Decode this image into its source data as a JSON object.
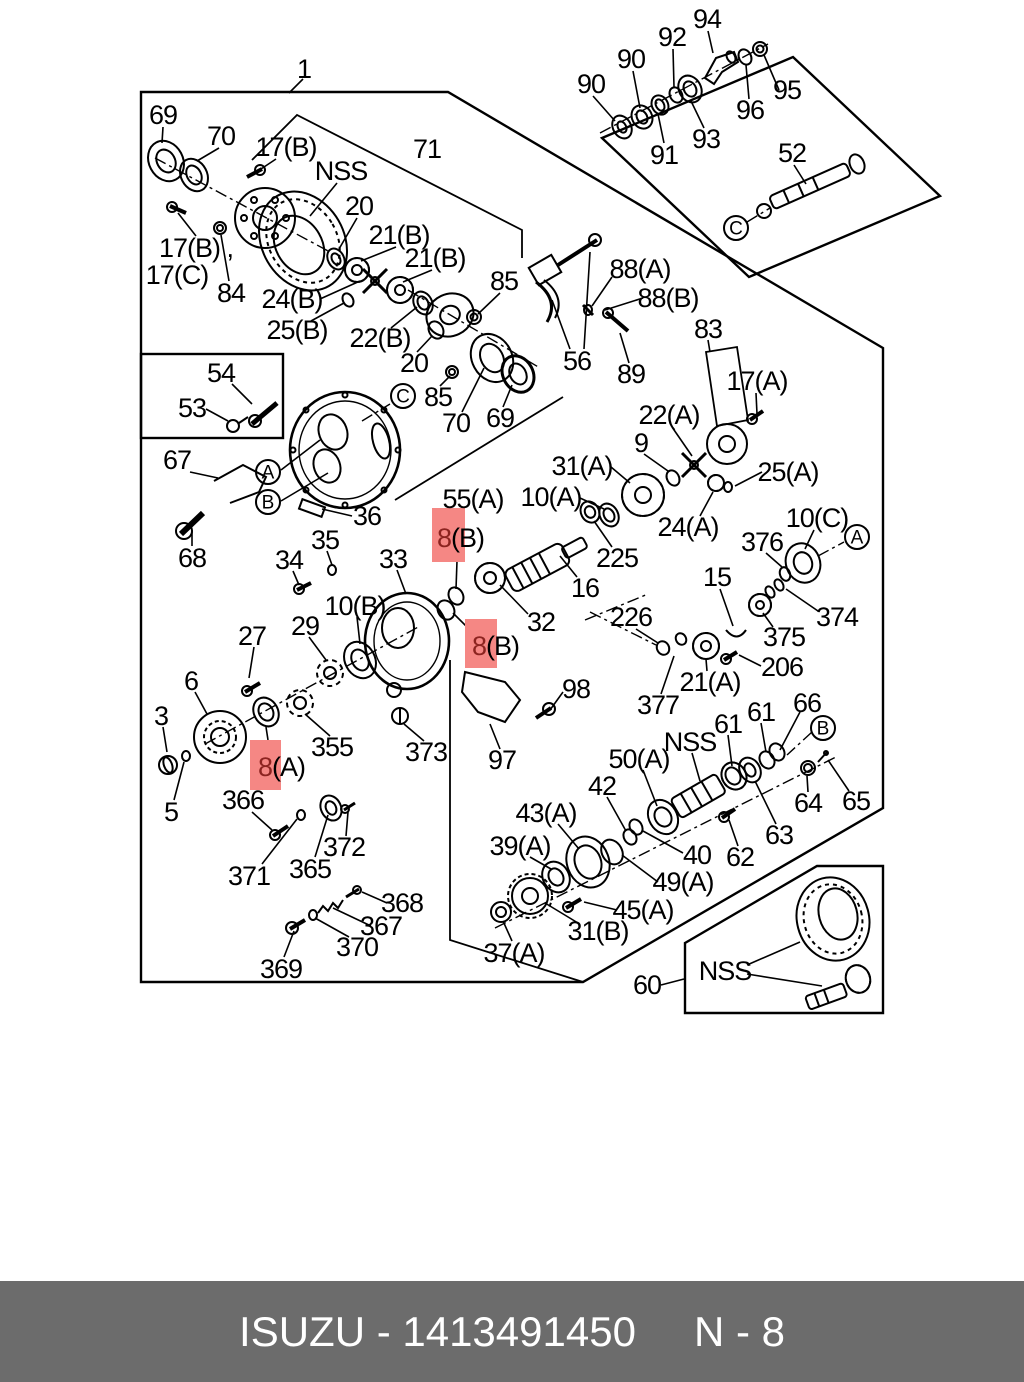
{
  "page": {
    "bg": "#ffffff",
    "line_color": "#000000"
  },
  "footer": {
    "left_text": "ISUZU - 1413491450",
    "right_text": "N - 8",
    "bg": "#6c6c6c",
    "color": "#ffffff"
  },
  "highlight": {
    "fill": "#f58784",
    "digit_color": "#8c2420"
  },
  "diagram": {
    "labels": [
      {
        "t": "1",
        "x": 304,
        "y": 69
      },
      {
        "t": "69",
        "x": 163,
        "y": 115
      },
      {
        "t": "70",
        "x": 221,
        "y": 136
      },
      {
        "t": "17(B)",
        "x": 286,
        "y": 147
      },
      {
        "t": "NSS",
        "x": 341,
        "y": 171
      },
      {
        "t": "71",
        "x": 427,
        "y": 149
      },
      {
        "t": "20",
        "x": 359,
        "y": 206
      },
      {
        "t": "21(B)",
        "x": 399,
        "y": 235
      },
      {
        "t": "21(B)",
        "x": 435,
        "y": 258
      },
      {
        "t": "85",
        "x": 504,
        "y": 281
      },
      {
        "t": "17(B) ,",
        "x": 196,
        "y": 248
      },
      {
        "t": "17(C)",
        "x": 177,
        "y": 275
      },
      {
        "t": "84",
        "x": 231,
        "y": 293
      },
      {
        "t": "24(B)",
        "x": 292,
        "y": 299
      },
      {
        "t": "25(B)",
        "x": 297,
        "y": 330
      },
      {
        "t": "22(B)",
        "x": 380,
        "y": 338
      },
      {
        "t": "20",
        "x": 414,
        "y": 363
      },
      {
        "t": "54",
        "x": 221,
        "y": 373
      },
      {
        "t": "53",
        "x": 192,
        "y": 408
      },
      {
        "t": "85",
        "x": 438,
        "y": 397
      },
      {
        "t": "70",
        "x": 456,
        "y": 423
      },
      {
        "t": "69",
        "x": 500,
        "y": 418
      },
      {
        "t": "56",
        "x": 577,
        "y": 361
      },
      {
        "t": "88(A)",
        "x": 640,
        "y": 269
      },
      {
        "t": "88(B)",
        "x": 668,
        "y": 298
      },
      {
        "t": "89",
        "x": 631,
        "y": 374
      },
      {
        "t": "83",
        "x": 708,
        "y": 329
      },
      {
        "t": "17(A)",
        "x": 757,
        "y": 381
      },
      {
        "t": "67",
        "x": 177,
        "y": 460
      },
      {
        "t": "68",
        "x": 192,
        "y": 558
      },
      {
        "t": "22(A)",
        "x": 669,
        "y": 415
      },
      {
        "t": "9",
        "x": 641,
        "y": 443
      },
      {
        "t": "31(A)",
        "x": 582,
        "y": 466
      },
      {
        "t": "10(A)",
        "x": 551,
        "y": 497
      },
      {
        "t": "25(A)",
        "x": 788,
        "y": 472
      },
      {
        "t": "24(A)",
        "x": 688,
        "y": 527
      },
      {
        "t": "10(C)",
        "x": 817,
        "y": 518
      },
      {
        "t": "376",
        "x": 762,
        "y": 542
      },
      {
        "t": "225",
        "x": 617,
        "y": 558
      },
      {
        "t": "15",
        "x": 717,
        "y": 577
      },
      {
        "t": "374",
        "x": 837,
        "y": 617
      },
      {
        "t": "375",
        "x": 784,
        "y": 637
      },
      {
        "t": "226",
        "x": 631,
        "y": 617
      },
      {
        "t": "206",
        "x": 782,
        "y": 667
      },
      {
        "t": "16",
        "x": 585,
        "y": 588
      },
      {
        "t": "32",
        "x": 541,
        "y": 622
      },
      {
        "t": "55(A)",
        "x": 473,
        "y": 499
      },
      {
        "t": "8(B)",
        "x": 437,
        "y": 538,
        "anchor": "start",
        "hl": true,
        "box": {
          "x": 432,
          "y": 508,
          "w": 33,
          "h": 54
        }
      },
      {
        "t": "8(B)",
        "x": 472,
        "y": 646,
        "anchor": "start",
        "hl": true,
        "box": {
          "x": 465,
          "y": 619,
          "w": 32,
          "h": 49
        }
      },
      {
        "t": "8(A)",
        "x": 258,
        "y": 767,
        "anchor": "start",
        "hl": true,
        "box": {
          "x": 250,
          "y": 740,
          "w": 31,
          "h": 50
        }
      },
      {
        "t": "36",
        "x": 367,
        "y": 516
      },
      {
        "t": "35",
        "x": 325,
        "y": 540
      },
      {
        "t": "34",
        "x": 289,
        "y": 560
      },
      {
        "t": "33",
        "x": 393,
        "y": 559
      },
      {
        "t": "10(B)",
        "x": 355,
        "y": 606
      },
      {
        "t": "29",
        "x": 305,
        "y": 626
      },
      {
        "t": "27",
        "x": 252,
        "y": 636
      },
      {
        "t": "98",
        "x": 576,
        "y": 689
      },
      {
        "t": "6",
        "x": 191,
        "y": 681
      },
      {
        "t": "3",
        "x": 161,
        "y": 716
      },
      {
        "t": "5",
        "x": 171,
        "y": 812
      },
      {
        "t": "355",
        "x": 332,
        "y": 747
      },
      {
        "t": "373",
        "x": 426,
        "y": 752
      },
      {
        "t": "97",
        "x": 502,
        "y": 760
      },
      {
        "t": "366",
        "x": 243,
        "y": 800
      },
      {
        "t": "371",
        "x": 249,
        "y": 876
      },
      {
        "t": "365",
        "x": 310,
        "y": 869
      },
      {
        "t": "372",
        "x": 344,
        "y": 847
      },
      {
        "t": "368",
        "x": 402,
        "y": 903
      },
      {
        "t": "367",
        "x": 381,
        "y": 926
      },
      {
        "t": "370",
        "x": 357,
        "y": 947
      },
      {
        "t": "369",
        "x": 281,
        "y": 969
      },
      {
        "t": "37(A)",
        "x": 514,
        "y": 953
      },
      {
        "t": "31(B)",
        "x": 598,
        "y": 931
      },
      {
        "t": "45(A)",
        "x": 643,
        "y": 910
      },
      {
        "t": "39(A)",
        "x": 520,
        "y": 846
      },
      {
        "t": "43(A)",
        "x": 546,
        "y": 813
      },
      {
        "t": "42",
        "x": 602,
        "y": 786
      },
      {
        "t": "50(A)",
        "x": 639,
        "y": 759
      },
      {
        "t": "NSS",
        "x": 690,
        "y": 742
      },
      {
        "t": "40",
        "x": 697,
        "y": 855
      },
      {
        "t": "49(A)",
        "x": 683,
        "y": 882
      },
      {
        "t": "62",
        "x": 740,
        "y": 857
      },
      {
        "t": "63",
        "x": 779,
        "y": 835
      },
      {
        "t": "61",
        "x": 728,
        "y": 724
      },
      {
        "t": "61",
        "x": 761,
        "y": 712
      },
      {
        "t": "66",
        "x": 807,
        "y": 703
      },
      {
        "t": "64",
        "x": 808,
        "y": 803
      },
      {
        "t": "65",
        "x": 856,
        "y": 801
      },
      {
        "t": "21(A)",
        "x": 710,
        "y": 682
      },
      {
        "t": "377",
        "x": 658,
        "y": 705
      },
      {
        "t": "60",
        "x": 647,
        "y": 985
      },
      {
        "t": "NSS",
        "x": 725,
        "y": 971
      },
      {
        "t": "52",
        "x": 792,
        "y": 153
      },
      {
        "t": "90",
        "x": 591,
        "y": 84
      },
      {
        "t": "90",
        "x": 631,
        "y": 59
      },
      {
        "t": "92",
        "x": 672,
        "y": 37
      },
      {
        "t": "94",
        "x": 707,
        "y": 19
      },
      {
        "t": "91",
        "x": 664,
        "y": 155
      },
      {
        "t": "93",
        "x": 706,
        "y": 139
      },
      {
        "t": "96",
        "x": 750,
        "y": 110
      },
      {
        "t": "95",
        "x": 787,
        "y": 90
      }
    ],
    "circled_letters": [
      {
        "ch": "A",
        "x": 268,
        "y": 472
      },
      {
        "ch": "B",
        "x": 268,
        "y": 502
      },
      {
        "ch": "C",
        "x": 403,
        "y": 396
      },
      {
        "ch": "C",
        "x": 736,
        "y": 228
      },
      {
        "ch": "A",
        "x": 857,
        "y": 537
      },
      {
        "ch": "B",
        "x": 823,
        "y": 728
      }
    ]
  }
}
